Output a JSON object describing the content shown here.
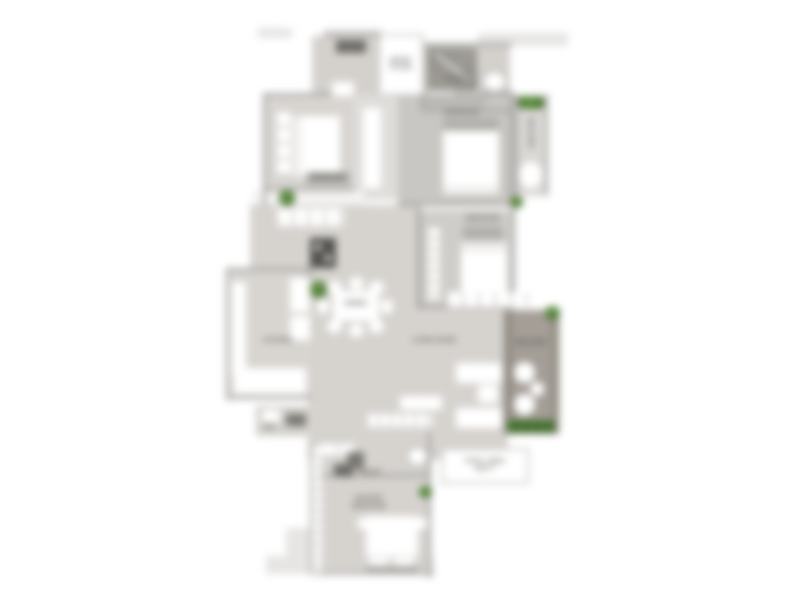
{
  "plan_type": "apartment-floor-plan",
  "labels": {
    "entry_box_line1": "ENTRY",
    "entry_box_line2": "FOYER",
    "toilet_top": "TOILET",
    "bedroom_top_left": "BEDROOM",
    "bedroom_top_right": "BEDROOM",
    "bedroom_mid_right": "BEDROOM",
    "balcony_top": "BALCONY",
    "balcony_right": "BALCONY",
    "kitchen": "KITCHEN",
    "dining": "DINING",
    "living": "LIVING ROOM",
    "wc": "WC",
    "toilet_bottom": "TOILET",
    "master_line1": "MASTER",
    "master_line2": "BEDROOM",
    "area_box_line1": "TOTAL AREA",
    "area_box_line2": "SQ.FT."
  },
  "colors": {
    "background": "#ffffff",
    "floor_light": "#d8d5d1",
    "floor_dark": "#c9c7c3",
    "walkway": "#e6e5e3",
    "wall": "#a5a3a0",
    "fixture_dark": "#6f6d69",
    "appliance": "#55534f",
    "plant_green": "#4c7a33",
    "wood_deck": "#a39d96",
    "furniture": "#ffffff",
    "label_text": "#565450"
  }
}
